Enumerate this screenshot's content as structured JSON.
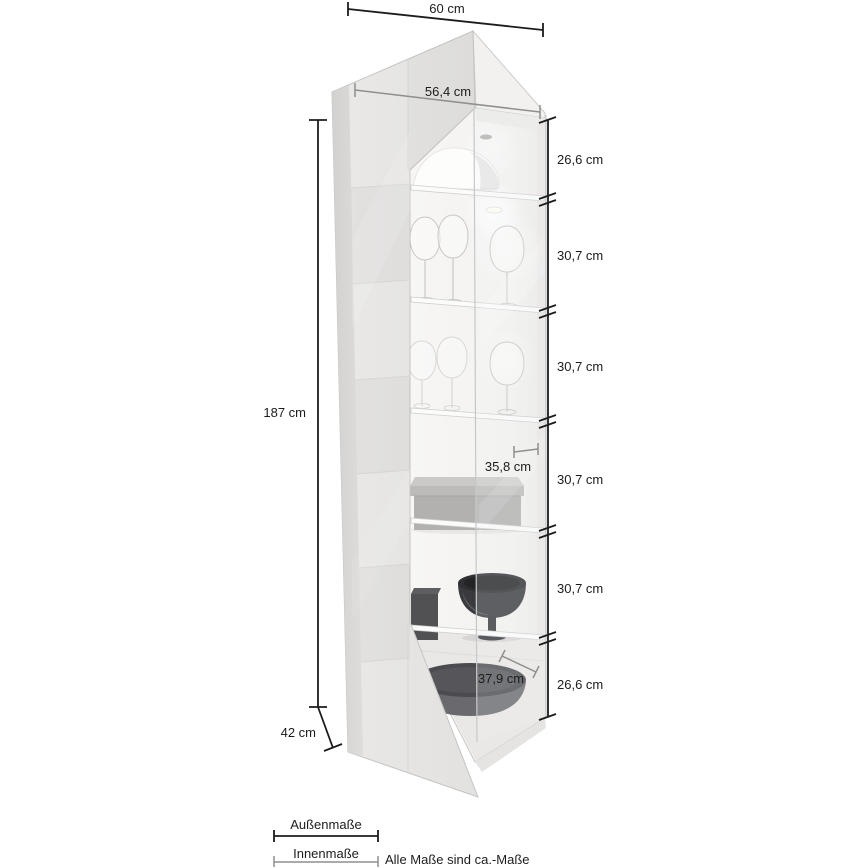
{
  "dimensions": {
    "outer_width_top": "60 cm",
    "inner_width_top": "56,4 cm",
    "outer_height": "187 cm",
    "outer_depth": "42 cm",
    "inner_shelf_width": "35,8 cm",
    "inner_bottom_width": "37,9 cm",
    "right_segments": [
      {
        "label": "26,6 cm"
      },
      {
        "label": "30,7 cm"
      },
      {
        "label": "30,7 cm"
      },
      {
        "label": "30,7 cm"
      },
      {
        "label": "30,7 cm"
      },
      {
        "label": "26,6 cm"
      }
    ]
  },
  "legend": {
    "outer_label": "Außenmaße",
    "inner_label": "Innenmaße",
    "note": "Alle Maße sind ca.-Maße"
  },
  "colors": {
    "outer_dimension_line": "#1c1c1c",
    "inner_dimension_line": "#8f8f8f",
    "text": "#1c1c1c",
    "cabinet_body": "#e7e6e4"
  }
}
